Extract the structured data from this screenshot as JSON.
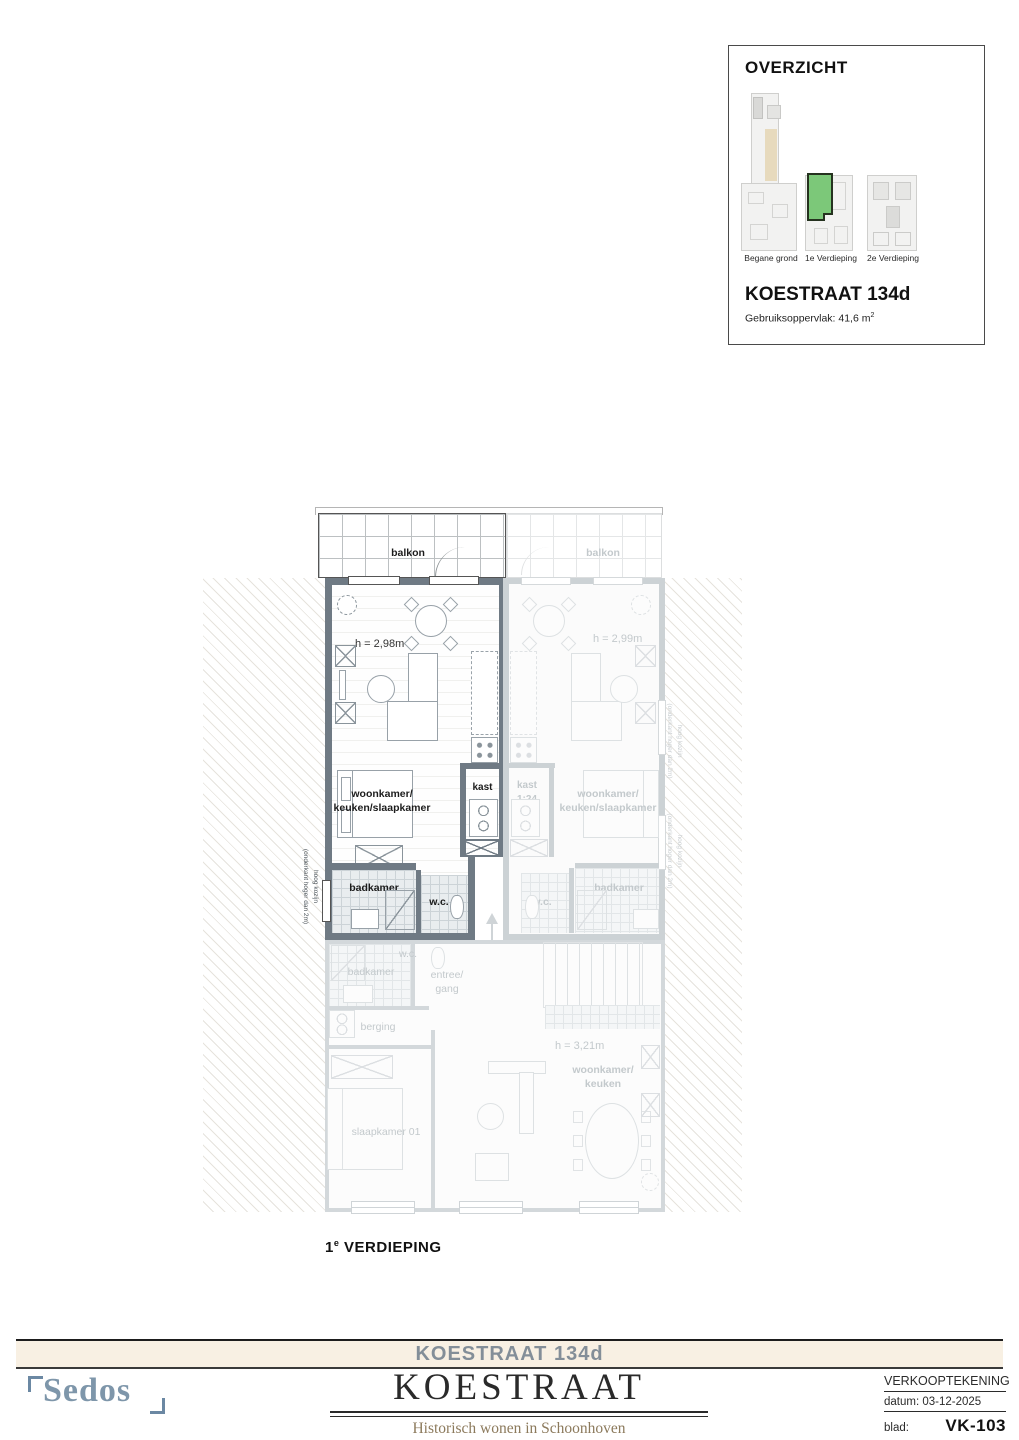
{
  "overzicht": {
    "title": "OVERZICHT",
    "floors": [
      {
        "label": "Begane grond",
        "highlighted": false
      },
      {
        "label": "1e Verdieping",
        "highlighted": true
      },
      {
        "label": "2e Verdieping",
        "highlighted": false
      }
    ],
    "property_title": "KOESTRAAT 134d",
    "area_label": "Gebruiksoppervlak: 41,6 m",
    "area_sup": "2"
  },
  "plan": {
    "caption": {
      "num": "1",
      "sup": "e",
      "rest": " VERDIEPING"
    },
    "active_unit": {
      "balkon": "balkon",
      "height": "h = 2,98m",
      "room_line1": "woonkamer/",
      "room_line2": "keuken/slaapkamer",
      "kast": "kast",
      "badkamer": "badkamer",
      "wc": "w.c.",
      "window_note_line1": "hoog kozijn",
      "window_note_line2": "(onderkant hoger dan 2m)"
    },
    "adjacent_unit": {
      "balkon": "balkon",
      "height": "h = 2,99m",
      "room_line1": "woonkamer/",
      "room_line2": "keuken/slaapkamer",
      "kast_line1": "kast",
      "kast_line2": "1:24",
      "badkamer": "badkamer",
      "wc": "w.c.",
      "window_note_line1": "hoog kozijn",
      "window_note_line2": "(onderkant hoger dan 2m)"
    },
    "lower_unit": {
      "badkamer": "badkamer",
      "wc": "w.c.",
      "entree_line1": "entree/",
      "entree_line2": "gang",
      "berging": "berging",
      "slaapkamer": "slaapkamer 01",
      "height": "h = 3,21m",
      "room_line1": "woonkamer/",
      "room_line2": "keuken"
    }
  },
  "footer": {
    "address_bar": "KOESTRAAT 134d",
    "brand": "Sedos",
    "project_title": "KOESTRAAT",
    "project_subtitle": "Historisch wonen in Schoonhoven",
    "drawing_type": "VERKOOPTEKENING",
    "date_label": "datum:",
    "date_value": "03-12-2025",
    "sheet_label": "blad:",
    "sheet_value": "VK-103"
  },
  "colors": {
    "highlight_green": "#7cc879",
    "wall_dark": "#6f7a84",
    "wall_faded": "#ccd2d5",
    "bar_beige": "#f8f0e3",
    "brand_blue": "#7e96aa",
    "subtitle_brown": "#8c7a5c",
    "address_grey": "#838e98"
  }
}
